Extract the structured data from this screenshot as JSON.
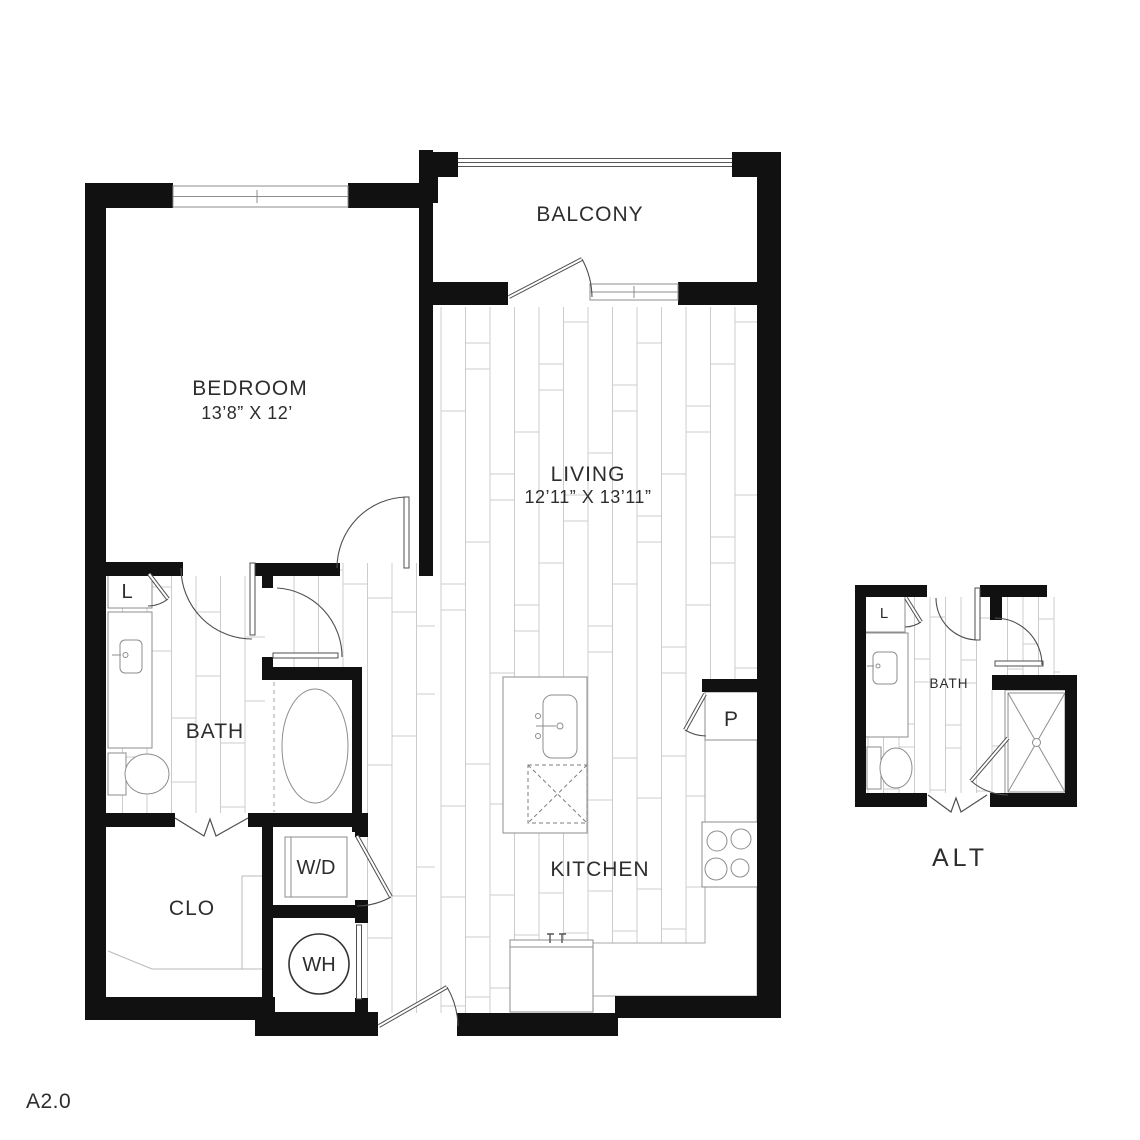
{
  "plan": {
    "sheet_label": "A2.0",
    "rooms": {
      "balcony": {
        "label": "BALCONY"
      },
      "bedroom": {
        "label": "BEDROOM",
        "dimensions": "13’8” X 12’"
      },
      "living": {
        "label": "LIVING",
        "dimensions": "12’11” X 13’11”"
      },
      "bath": {
        "label": "BATH"
      },
      "kitchen": {
        "label": "KITCHEN"
      },
      "closet": {
        "label": "CLO"
      },
      "washer_dryer": {
        "label": "W/D"
      },
      "water_heater": {
        "label": "WH"
      },
      "linen": {
        "label": "L"
      },
      "pantry": {
        "label": "P"
      }
    },
    "alt": {
      "caption": "ALT",
      "bath_label": "BATH",
      "linen_label": "L"
    },
    "colors": {
      "wall": "#111111",
      "fixture_line": "#8d8d8d",
      "plank_line": "#cccccc",
      "door_line": "#4f4f4f",
      "text": "#2d2d2d"
    }
  }
}
